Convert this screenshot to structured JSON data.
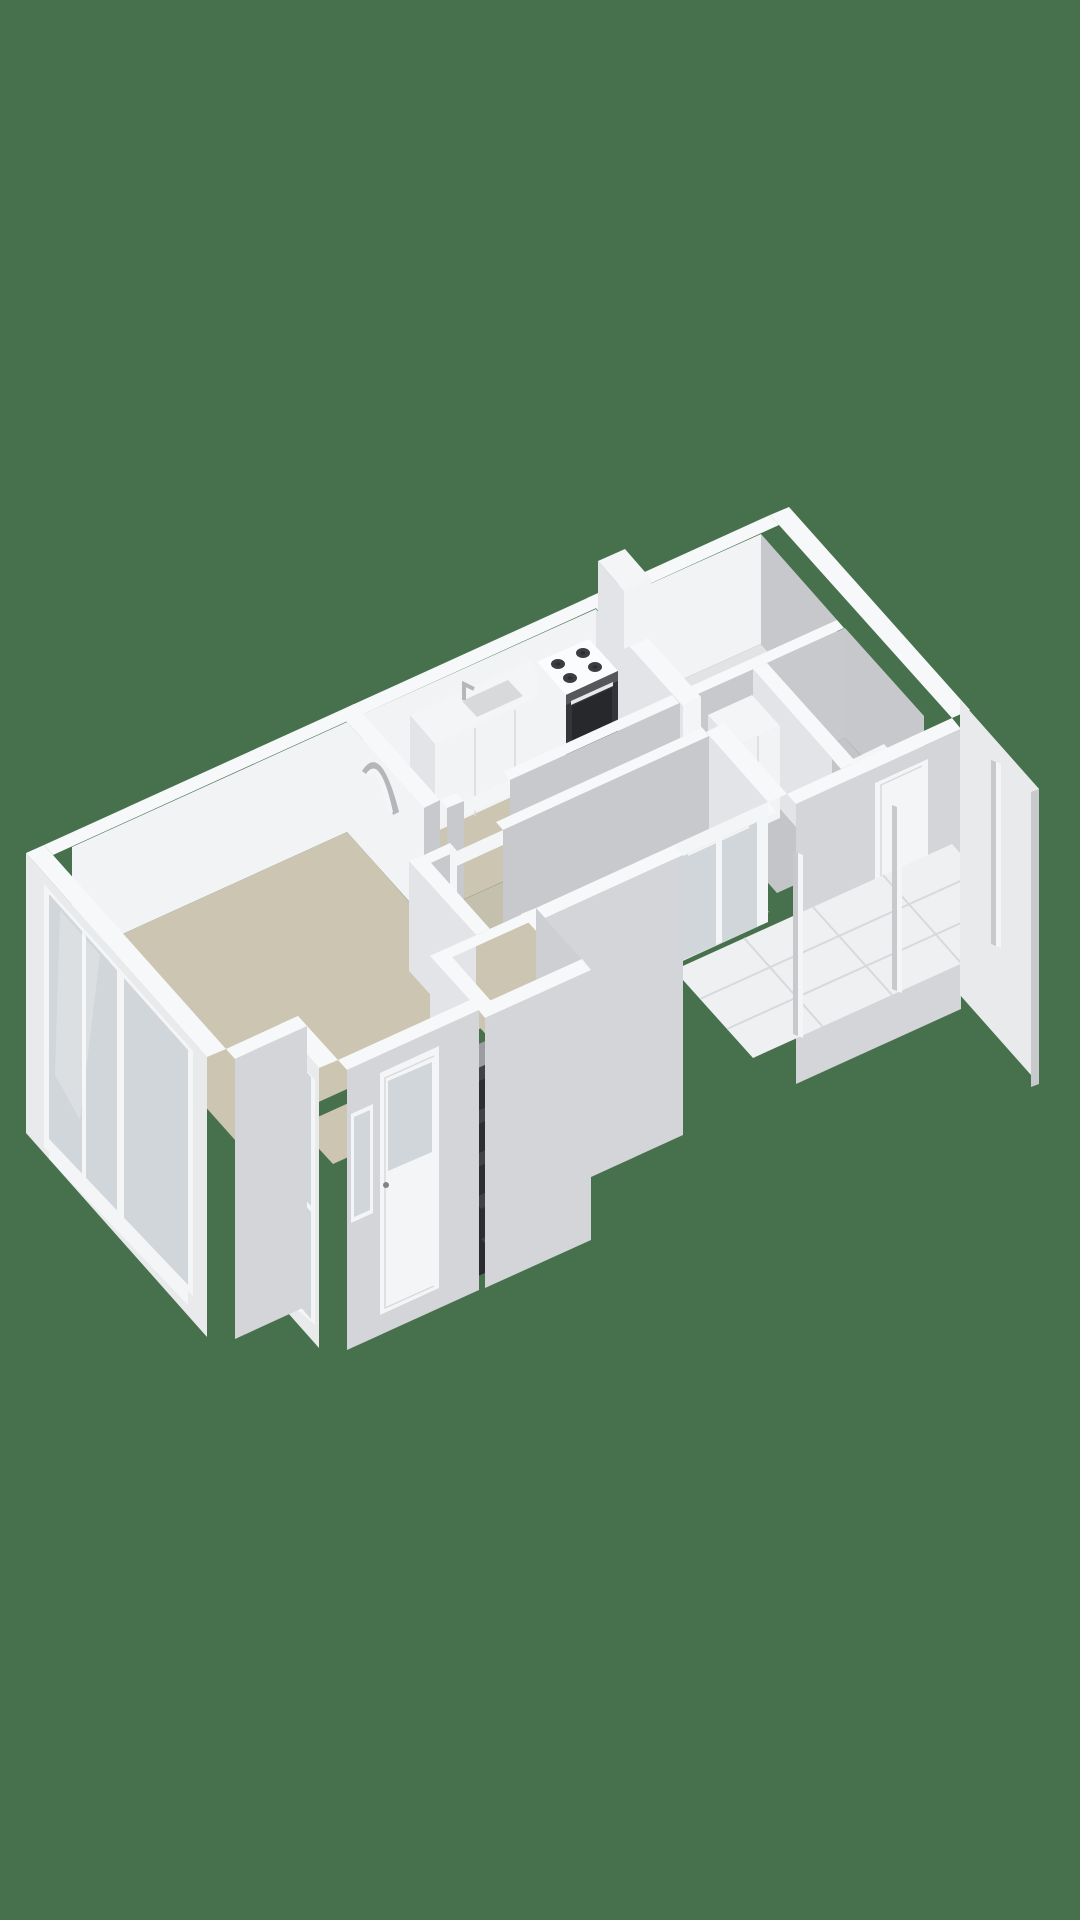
{
  "scene": {
    "type": "3d-floorplan-render",
    "view": "isometric-birdseye",
    "background_color": "#47714d",
    "has_text": false
  },
  "colors": {
    "bg": "#47714d",
    "wallTop": "#f7f8f9",
    "wallFaceLight": "#e2e4e7",
    "wallFaceMed": "#c7c9cc",
    "wallFaceGray": "#c6c8cb",
    "wallFaceBright": "#f1f3f5",
    "extWallShade": "#d3d5d8",
    "extWallLight": "#e9eaec",
    "trimWhite": "#f4f5f7",
    "floorBeige": "#cbc5b2",
    "floorBeigeDark": "#c5bfad",
    "floorBath": "#e2e3e5",
    "floorGray": "#c3c5c8",
    "balconyTile": "#eef0f2",
    "tileGrout": "#d7dadc",
    "glass": "#ccd2d6",
    "seamGray": "#d8dadc",
    "stoveTop": "#fbfcfd",
    "burner": "#3b3d41",
    "burnerCenter": "#2b2d30",
    "ovenFront": "#33353a",
    "ovenWindow": "#26282b",
    "knobStrip": "#55575b",
    "ovenHandle": "#e8e9eb",
    "sinkBasin": "#d7d9db",
    "stepTop": "#3f4145",
    "stepRiser": "#2c2e31",
    "pitWallDark": "#9b9da1",
    "pitWallBack": "#cdcfd2",
    "pitFloor": "#2a2b2e",
    "railOrange": "#b5572f",
    "railOrangeFront": "#a04a27",
    "railOrangeSide": "#8c3e22",
    "archShadow": "#b4b6ba"
  },
  "rooms": [
    {
      "id": "living-room",
      "floor": "beige"
    },
    {
      "id": "kitchen",
      "floor": "beige"
    },
    {
      "id": "hallway",
      "floor": "beige"
    },
    {
      "id": "bedroom",
      "floor": "beige"
    },
    {
      "id": "bathroom",
      "floor": "light"
    },
    {
      "id": "toilet-room",
      "floor": "gray"
    },
    {
      "id": "upper-hall",
      "floor": "gray"
    },
    {
      "id": "entrance-vestibule",
      "floor": "beige"
    },
    {
      "id": "balcony",
      "floor": "white-tiles"
    },
    {
      "id": "staircase",
      "floor": "dark-steps"
    }
  ],
  "features": [
    "gas-stove-with-oven",
    "kitchen-counter",
    "kitchen-sink",
    "faucet",
    "arched-wall-niche",
    "closet",
    "toilet-cistern",
    "boiler-box-on-wall",
    "sliding-glass-door",
    "balcony-railing-posts",
    "balcony-parapet",
    "staircase-down",
    "orange-handrail-newel",
    "front-door-with-window",
    "entry-side-window",
    "panorama-sliding-window",
    "exterior-door",
    "interior-door-openings"
  ]
}
